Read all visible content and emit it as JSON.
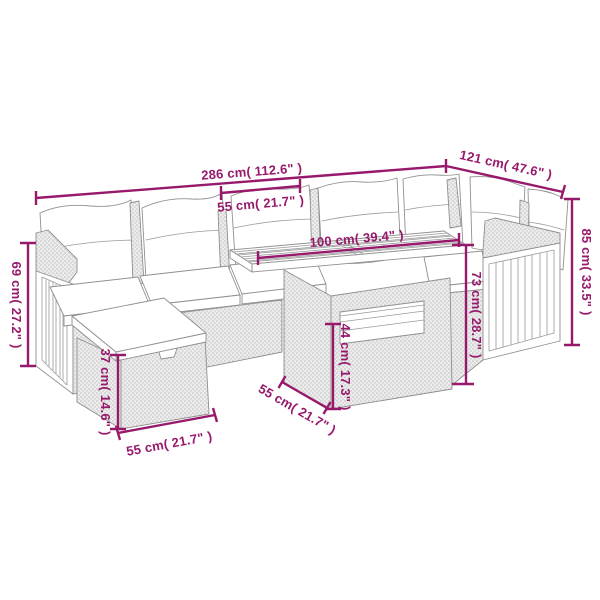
{
  "diagram": {
    "kind": "product-dimension-diagram",
    "subject": "rattan garden lounge set with corner sofa, table and footstool",
    "background_color": "#ffffff",
    "annotation_color": "#97196c",
    "line_art_color": "#909090",
    "dimensions": [
      {
        "id": "total-width",
        "label": "286 cm( 112.6\" )"
      },
      {
        "id": "right-section-depth",
        "label": "121 cm( 47.6\" )"
      },
      {
        "id": "seat-width",
        "label": "55 cm( 21.7\" )"
      },
      {
        "id": "table-length",
        "label": "100 cm( 39.4\" )"
      },
      {
        "id": "back-height",
        "label": "85 cm( 33.5\" )"
      },
      {
        "id": "armrest-height",
        "label": "69 cm( 27.2\" )"
      },
      {
        "id": "table-height",
        "label": "73 cm( 28.7\" )"
      },
      {
        "id": "table-shelf-height",
        "label": "44 cm( 17.3\" )"
      },
      {
        "id": "footstool-height",
        "label": "37 cm( 14.6\" )"
      },
      {
        "id": "footstool-width",
        "label": "55 cm( 21.7\" )"
      },
      {
        "id": "table-depth",
        "label": "55 cm( 21.7\" )"
      }
    ]
  }
}
